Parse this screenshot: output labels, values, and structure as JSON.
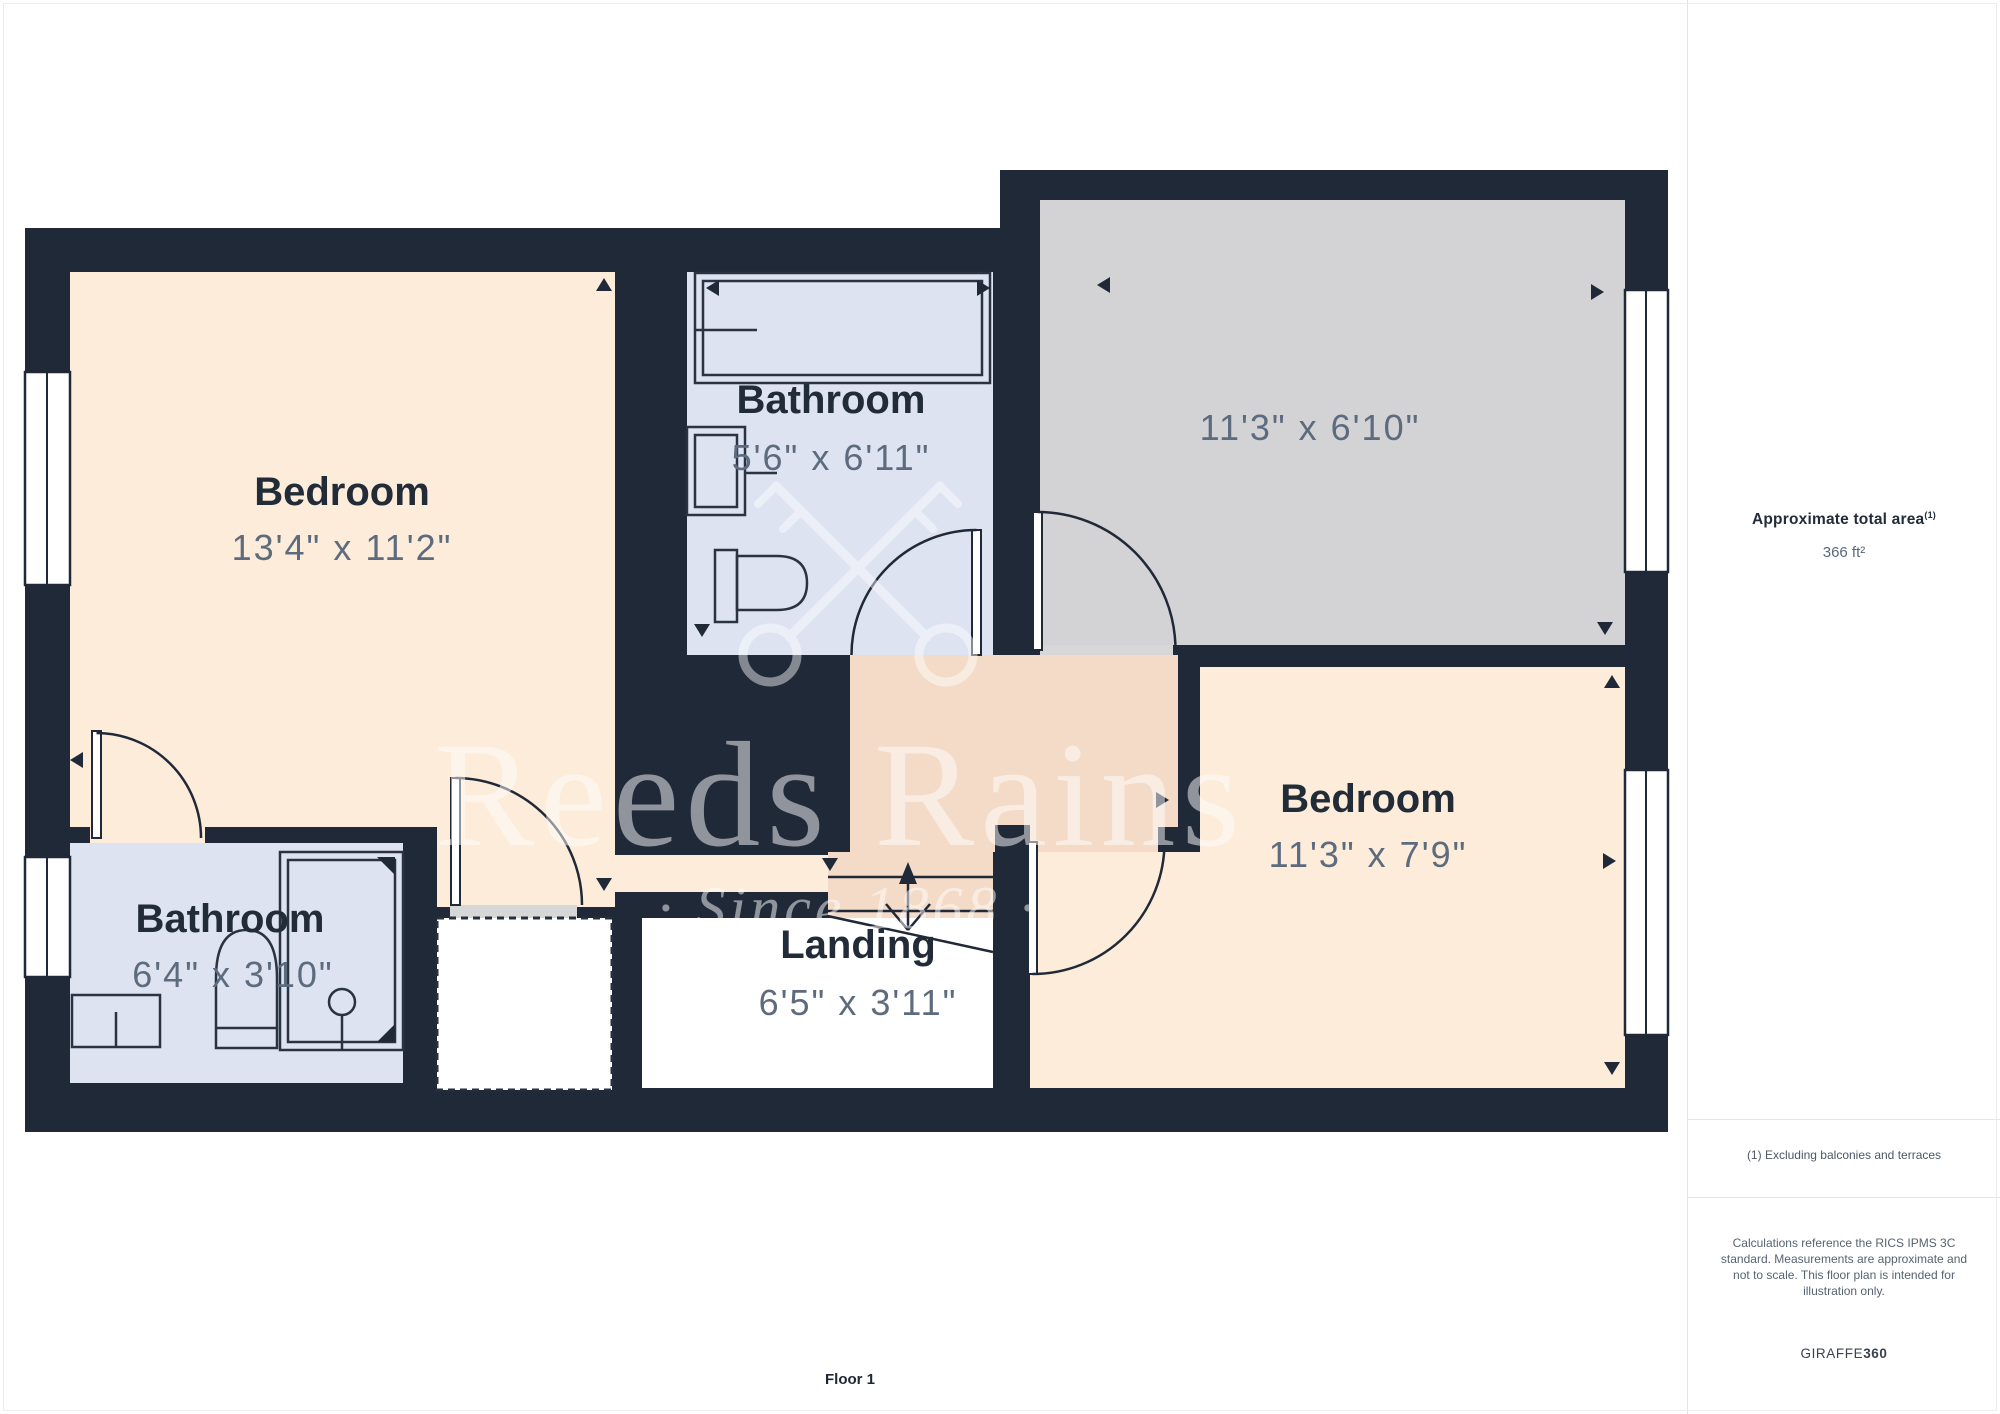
{
  "page": {
    "floor_label": "Floor 1"
  },
  "watermark": {
    "brand": "Reeds Rains",
    "tagline": "·  Since 1868  ·"
  },
  "rooms": {
    "bedroom1": {
      "name": "Bedroom",
      "dims": "13'4\" x 11'2\""
    },
    "bathroom1": {
      "name": "Bathroom",
      "dims": "5'6\" x 6'11\""
    },
    "gray_room": {
      "dims": "11'3\" x 6'10\""
    },
    "bathroom2": {
      "name": "Bathroom",
      "dims": "6'4\" x 3'10\""
    },
    "landing": {
      "name": "Landing",
      "dims": "6'5\" x 3'11\""
    },
    "bedroom2": {
      "name": "Bedroom",
      "dims": "11'3\" x 7'9\""
    }
  },
  "sidebar": {
    "area_title": "Approximate total area",
    "area_footnote_marker": "(1)",
    "area_value": "366 ft²",
    "footnote": "(1) Excluding balconies and terraces",
    "disclaimer": "Calculations reference the RICS IPMS 3C standard. Measurements are approximate and not to scale. This floor plan is intended for illustration only.",
    "brand_regular": "GIRAFFE",
    "brand_bold": "360"
  },
  "colors": {
    "wall": "#202938",
    "bedroom": "#fcecd9",
    "bathroom": "#dde3f1",
    "gray_room": "#d3d3d5",
    "hallway": "#f3dbc8",
    "threshold": "#d7d7d7",
    "landing": "#ffffff"
  }
}
